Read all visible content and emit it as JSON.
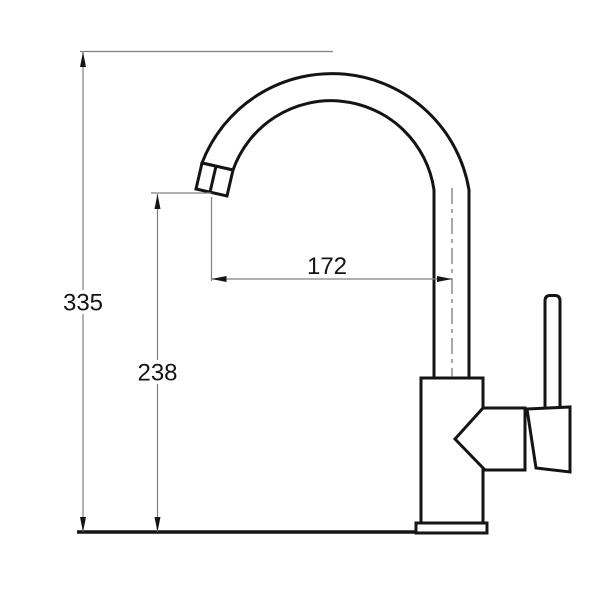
{
  "drawing": {
    "dimension_labels": {
      "overall_height": "335",
      "spout_outlet_height": "238",
      "spout_reach": "172"
    },
    "colors": {
      "outline": "#141414",
      "dimension_line": "#808080",
      "text": "#141414",
      "background": "#ffffff"
    }
  }
}
